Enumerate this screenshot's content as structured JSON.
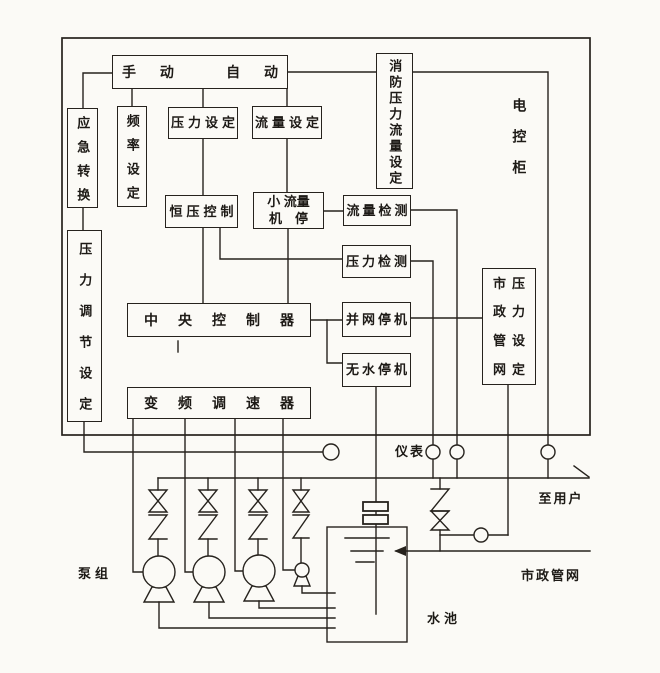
{
  "page": {
    "background": "#fbfaf6",
    "line_color": "#26221d"
  },
  "cabinet": {
    "label": "电控柜",
    "manual_label": "手 动",
    "auto_label": "自 动",
    "emergency_switch": "应急转换",
    "frequency_setting": "频率设定",
    "pressure_setting": "压力设定",
    "flow_setting": "流量设定",
    "fire_pressure_flow_setting": "消防压力流量设定",
    "constant_pressure_control": "恒压控制",
    "small_flow_stop": {
      "line1": "小 流量",
      "line2": "机　停"
    },
    "flow_detection": "流量检测",
    "pressure_detection": "压力检测",
    "central_controller": "中央控制器",
    "grid_connect_stop": "并网停机",
    "no_water_stop": "无水停机",
    "pressure_regulation_setting": "压力调节设定",
    "municipal_pressure_setting_rows": [
      "市压",
      "政力",
      "管设",
      "网定"
    ],
    "vfd": "变频调速器"
  },
  "field": {
    "instruments_label": "仪表",
    "pump_group_label": "泵组",
    "tank_label": "水池",
    "to_users_label": "至用户",
    "municipal_network_label": "市政管网"
  }
}
